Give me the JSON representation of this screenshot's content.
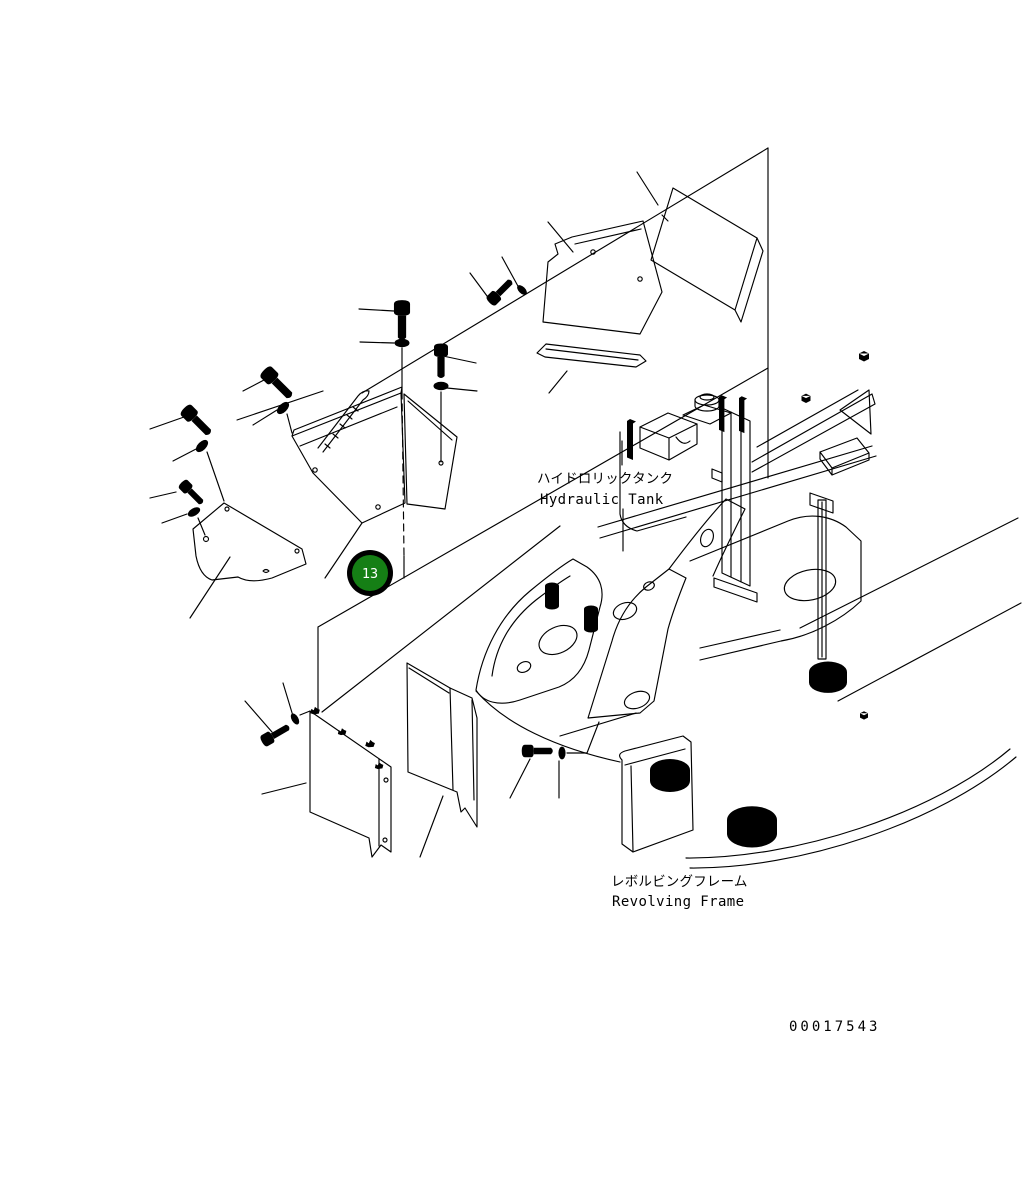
{
  "drawing_number": "00017543",
  "callout": {
    "number": "13",
    "fill_color": "#157f15",
    "ring_color": "#000000",
    "text_color": "#ffffff"
  },
  "labels": {
    "hydraulic_tank": {
      "jp": "ハイドロリックタンク",
      "en": "Hydraulic Tank"
    },
    "revolving_frame": {
      "jp": "レボルビングフレーム",
      "en": "Revolving Frame"
    }
  },
  "style": {
    "line_color": "#000000",
    "background_color": "#ffffff"
  },
  "components": [
    "top-cover-panel-right",
    "top-cover-panel-left",
    "flat-bracket-strip",
    "angled-support-strip",
    "center-cover-panel",
    "side-cover-panel",
    "lower-left-cover-panel",
    "lower-center-panel-with-clips",
    "lower-center-panel-plain",
    "mounting-bolts-x8",
    "washers-x8",
    "spring-clips-x4",
    "hydraulic-tank",
    "revolving-frame",
    "callout-balloon-13"
  ]
}
